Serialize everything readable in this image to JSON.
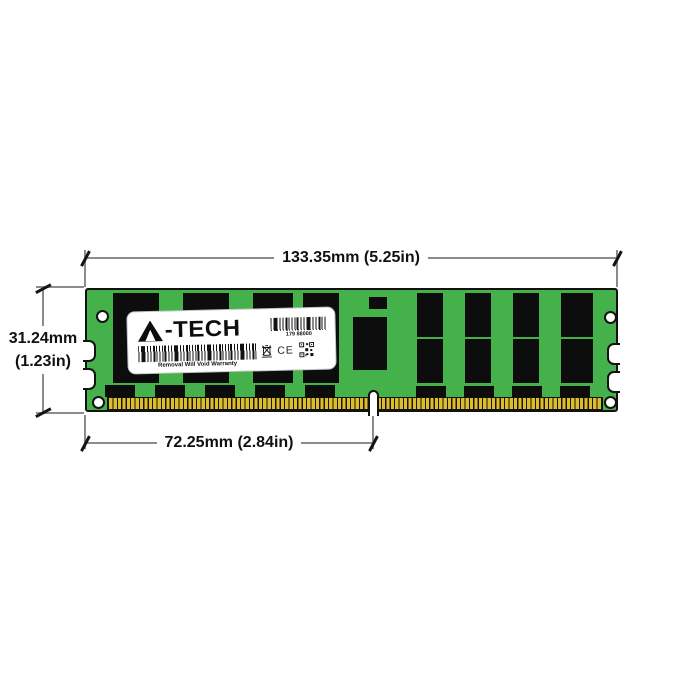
{
  "page": {
    "background_color": "#ffffff"
  },
  "module": {
    "colors": {
      "pcb_green": "#45b14a",
      "chip_black": "#0d0d0d",
      "pin_gold": "#dcbe2c",
      "outline_black": "#121212",
      "label_white": "#ffffff"
    },
    "label": {
      "brand": "A-TECH",
      "brand_suffix": "-TECH",
      "part_number": "179 88000",
      "warranty": "Removal Will Void Warranty",
      "ce_mark": "CE",
      "icons": [
        "triangle-a-logo",
        "barcode",
        "weee-crossed-bin-icon",
        "qr-code-icon"
      ]
    }
  },
  "dimensions": {
    "line_color": "#8c8c8c",
    "tick_color": "#141414",
    "width": "133.35mm (5.25in)",
    "height_mm": "31.24mm",
    "height_in": "(1.23in)",
    "pin_offset": "72.25mm (2.84in)"
  }
}
